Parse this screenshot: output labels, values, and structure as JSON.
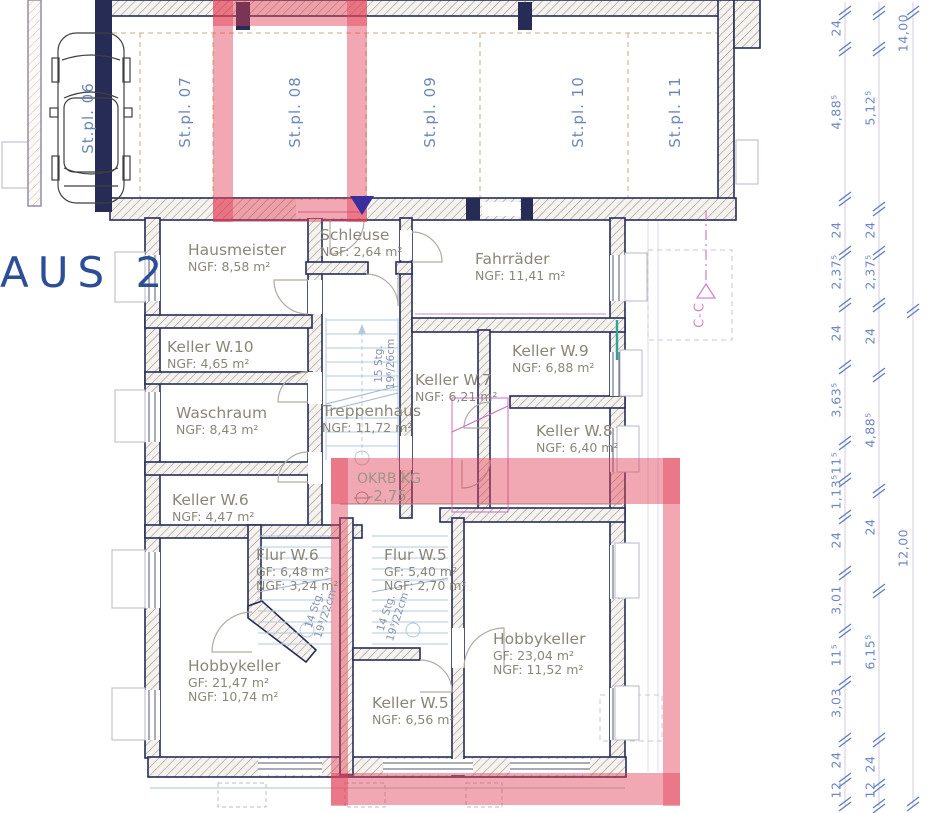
{
  "drawing": {
    "title_partial": "AUS 2"
  },
  "parking": {
    "spots": [
      {
        "label": "St.pl. 06"
      },
      {
        "label": "St.pl. 07"
      },
      {
        "label": "St.pl. 08"
      },
      {
        "label": "St.pl. 09"
      },
      {
        "label": "St.pl. 10"
      },
      {
        "label": "St.pl. 11"
      }
    ]
  },
  "rooms": {
    "hausmeister": {
      "name": "Hausmeister",
      "area": "NGF:  8,58 m²"
    },
    "schleuse": {
      "name": "Schleuse",
      "area": "NGF: 2,64 m²"
    },
    "fahrraeder": {
      "name": "Fahrräder",
      "area": "NGF: 11,41 m²"
    },
    "keller_w10": {
      "name": "Keller W.10",
      "area": "NGF: 4,65 m²"
    },
    "keller_w9": {
      "name": "Keller W.9",
      "area": "NGF: 6,88 m²"
    },
    "keller_w7": {
      "name": "Keller W.7",
      "area": "NGF: 6,21 m²"
    },
    "waschraum": {
      "name": "Waschraum",
      "area": "NGF:  8,43 m²"
    },
    "treppenhaus": {
      "name": "Treppenhaus",
      "area": "NGF:   11,72 m²"
    },
    "keller_w8": {
      "name": "Keller W.8",
      "area": "NGF: 6,40 m²"
    },
    "keller_w6": {
      "name": "Keller W.6",
      "area": "NGF: 4,47 m²"
    },
    "flur_w6": {
      "name": "Flur W.6",
      "gf": "GF:   6,48 m²",
      "area": "NGF: 3,24 m²"
    },
    "flur_w5": {
      "name": "Flur W.5",
      "gf": "GF:   5,40 m²",
      "area": "NGF: 2,70 m²"
    },
    "hobbykeller_links": {
      "name": "Hobbykeller",
      "gf": "GF:   21,47 m²",
      "area": "NGF: 10,74 m²"
    },
    "keller_w5": {
      "name": "Keller W.5",
      "area": "NGF: 6,56 m²"
    },
    "hobbykeller_rechts": {
      "name": "Hobbykeller",
      "gf": "GF: 23,04 m²",
      "area": "NGF: 11,52 m²"
    }
  },
  "annotations": {
    "level_label": "OKRB KG",
    "level_value": "-2,75",
    "section_label": "C-C",
    "stair_main": {
      "line1": "15 Stg.",
      "line2": "19⁶/26cm"
    },
    "stair_flur_w6": {
      "line1": "14 Stg.",
      "line2": "19³/22cm"
    },
    "stair_flur_w5": {
      "line1": "14 Stg.",
      "line2": "19³/22cm"
    }
  },
  "dimensions": {
    "chain_inner": [
      "24",
      "4,88⁵",
      "24",
      "2,37⁵",
      "24",
      "3,63⁵",
      "11⁵",
      "1,13⁵",
      "24",
      "3,01",
      "11⁵",
      "3,03",
      "24",
      "12"
    ],
    "chain_middle": [
      "5,12⁵",
      "24",
      "2,37⁵",
      "24",
      "4,88⁵",
      "24",
      "6,15⁵",
      "24",
      "12"
    ],
    "chain_outer": [
      "14,00",
      "12,00"
    ]
  },
  "colors": {
    "highlight_red": "#e23e54",
    "wall_navy": "#262c55",
    "room_text": "#8a8679",
    "parking_text": "#6b87b6",
    "dim_text": "#6e86c6",
    "section_pink": "#d884ca",
    "title_blue": "#2b4e97",
    "marker_purple": "#3b2f9e",
    "stair_blue": "#b6c8dc"
  }
}
